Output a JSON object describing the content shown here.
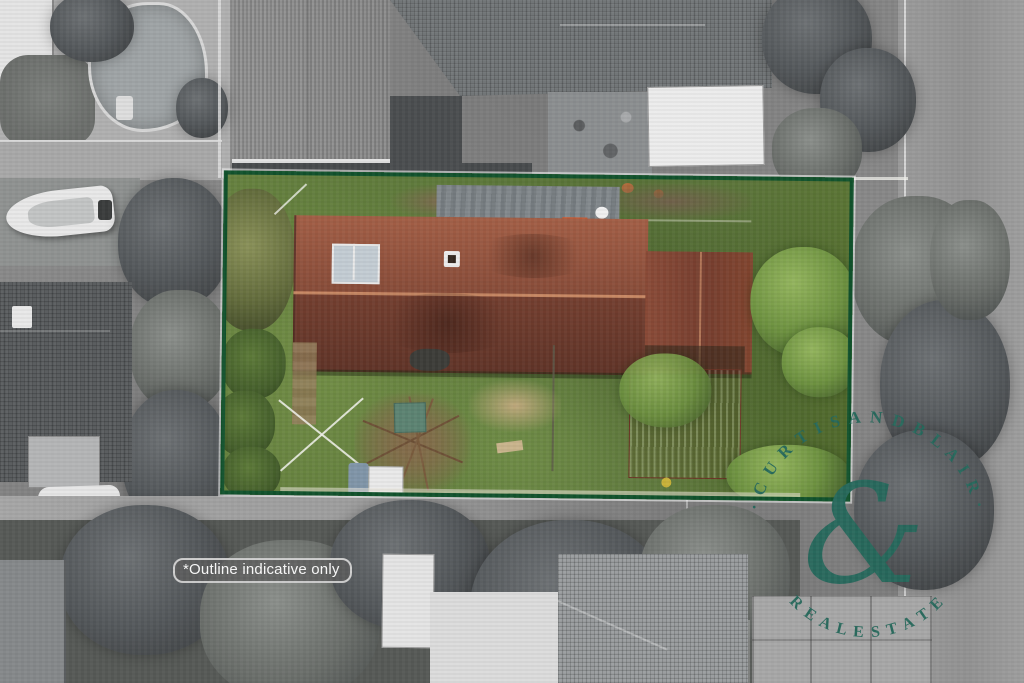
{
  "overlay": {
    "disclaimer_label": "*Outline indicative only",
    "watermark": {
      "arc_top_text": "·  C U R T I S   A N D   B L A I R  ·",
      "arc_bottom_text": "R E A L   E S T A T E",
      "ampersand": "&"
    }
  },
  "palette": {
    "outline_green": "#11522c",
    "outline_halo": "#ffffff",
    "watermark_teal": "#26695c",
    "lawn_green": "#5f7a3c",
    "roof_red": "#8d4d3b",
    "rust_shed_red": "#9e5038",
    "accent_orange_tiles": "#dd5a2b",
    "solar_panel_gray": "#c3ccd3",
    "monochrome_base": "#858585"
  }
}
